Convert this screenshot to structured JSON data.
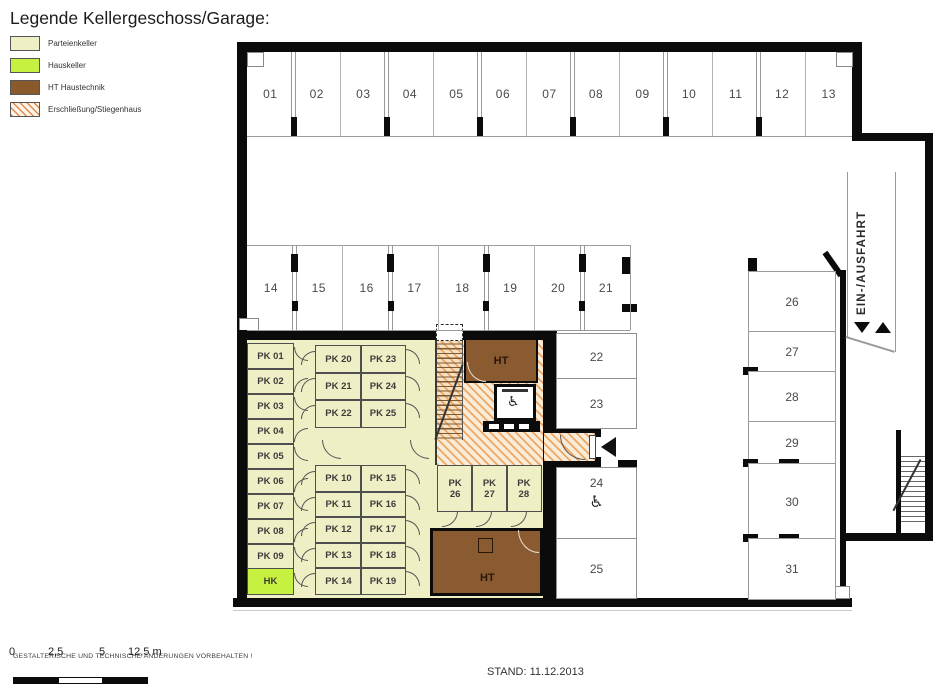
{
  "title": "Legende Kellergeschoss/Garage:",
  "legend": {
    "items": [
      {
        "label": "Parteienkeller",
        "color": "#EFEFC5",
        "style": "solid"
      },
      {
        "label": "Hauskeller",
        "color": "#C6F140",
        "style": "solid"
      },
      {
        "label": "HT Haustechnik",
        "color": "#8B5A2B",
        "style": "solid"
      },
      {
        "label": "Erschließung/Stiegenhaus",
        "color": "#E08A50",
        "style": "hatch"
      }
    ]
  },
  "plan": {
    "top_row_spots": [
      "01",
      "02",
      "03",
      "04",
      "05",
      "06",
      "07",
      "08",
      "09",
      "10",
      "11",
      "12",
      "13"
    ],
    "middle_row_spots": [
      "14",
      "15",
      "16",
      "17",
      "18",
      "19",
      "20",
      "21"
    ],
    "mid_right_rooms": [
      "22",
      "23",
      "24",
      "25"
    ],
    "right_column_rooms": [
      "26",
      "27",
      "28",
      "29",
      "30",
      "31"
    ],
    "ramp_label": "EIN-/AUSFAHRT",
    "accessible_symbol": "♿",
    "cellar": {
      "left_rooms": [
        "PK 01",
        "PK 02",
        "PK 03",
        "PK 04",
        "PK 05",
        "PK 06",
        "PK 07",
        "PK 08",
        "PK 09"
      ],
      "hk_label": "HK",
      "mid_col1_top": [
        "PK 20",
        "PK 21",
        "PK 22"
      ],
      "mid_col2_top": [
        "PK 23",
        "PK 24",
        "PK 25"
      ],
      "mid_col1_bottom": [
        "PK 10",
        "PK 11",
        "PK 12",
        "PK 13",
        "PK 14"
      ],
      "mid_col2_bottom": [
        "PK 15",
        "PK 16",
        "PK 17",
        "PK 18",
        "PK 19"
      ],
      "bottom_rooms": [
        [
          "PK",
          "26"
        ],
        [
          "PK",
          "27"
        ],
        [
          "PK",
          "28"
        ]
      ],
      "ht_top_label": "HT",
      "ht_bottom_label": "HT"
    }
  },
  "footer": {
    "disclaimer": "GESTALTERISCHE UND TECHNISCHE ÄNDERUNGEN VORBEHALTEN !",
    "scale_labels": [
      "0",
      "2,5",
      "5",
      "12,5 m"
    ],
    "stand": "STAND: 11.12.2013"
  }
}
